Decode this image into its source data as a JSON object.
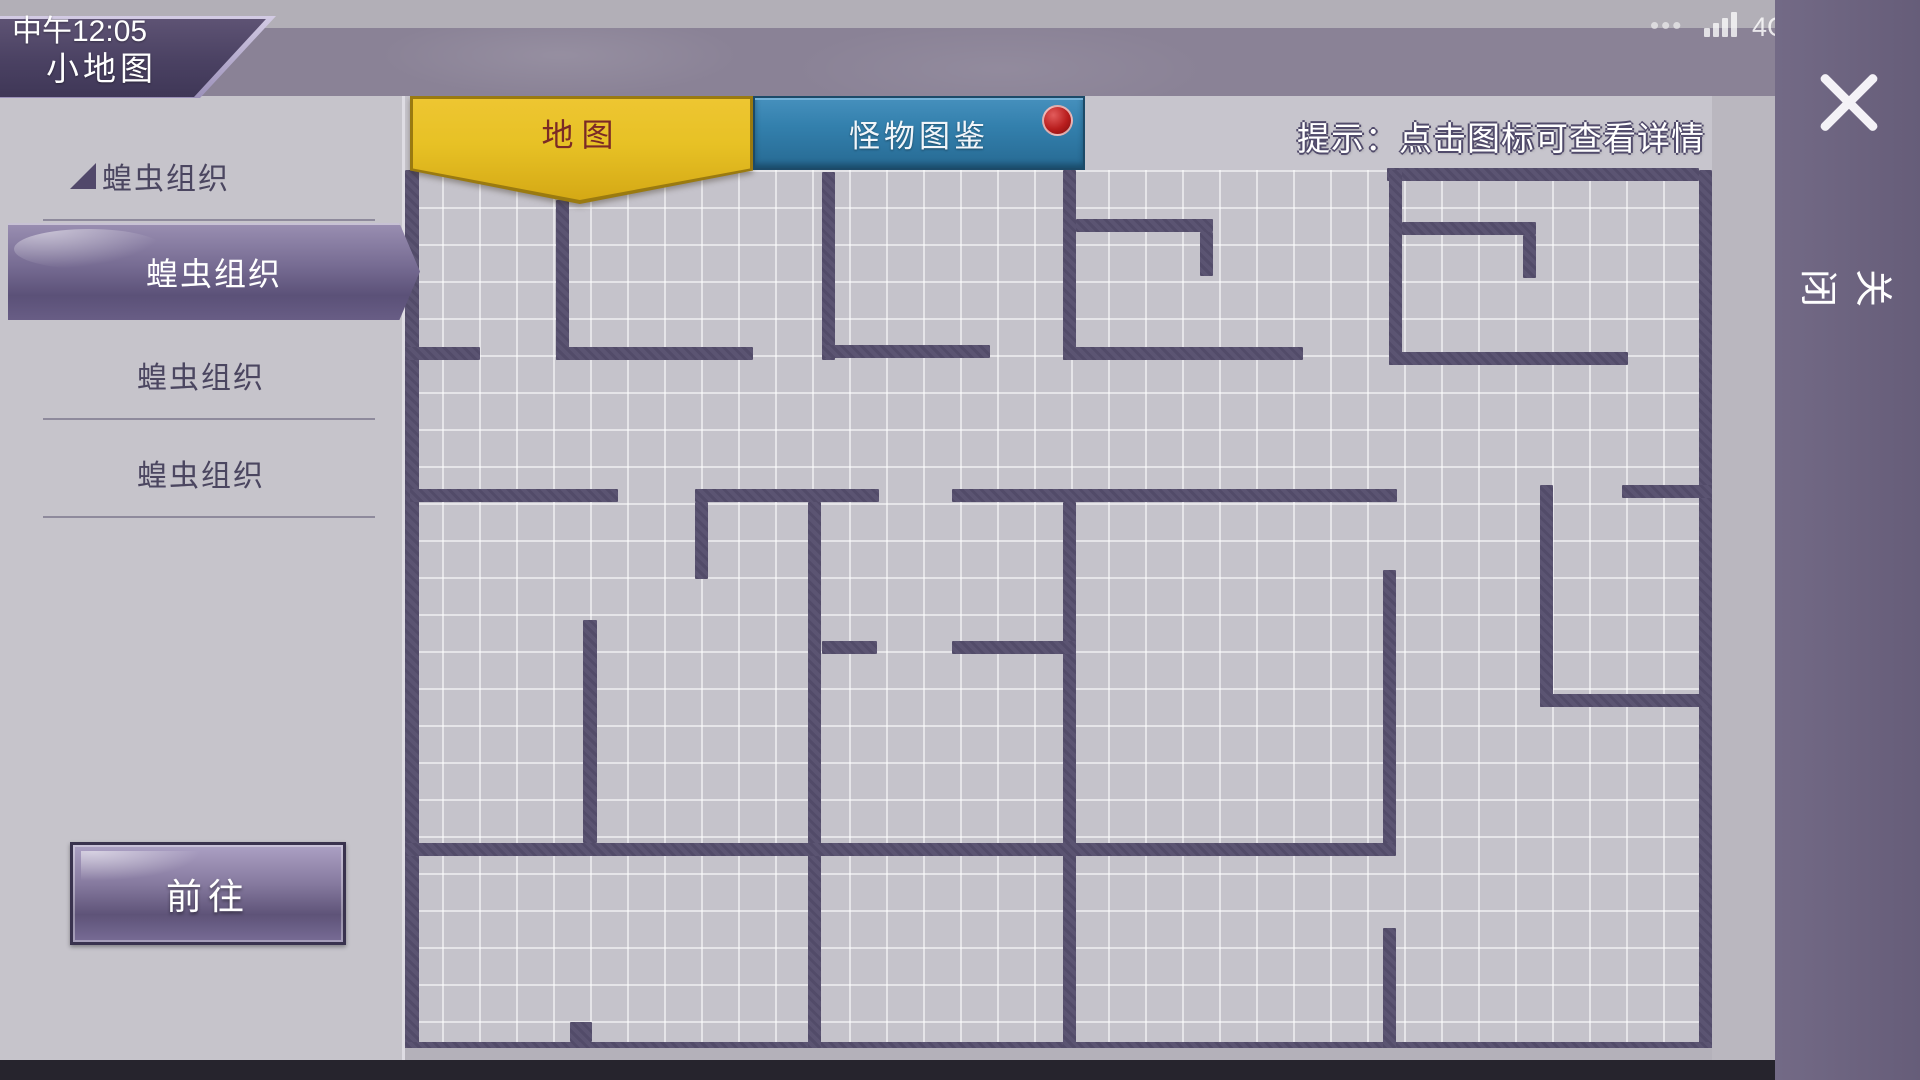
{
  "status_bar": {
    "time": "中午12:05",
    "page_title": "小地图",
    "menu_dots": "•••",
    "network": "4G",
    "network_arrows": "⇵",
    "battery_level": "82"
  },
  "right_panel": {
    "close_label": "关闭"
  },
  "sidebar": {
    "group_header": "蝗虫组织",
    "items": [
      {
        "label": "蝗虫组织",
        "selected": true
      },
      {
        "label": "蝗虫组织",
        "selected": false
      },
      {
        "label": "蝗虫组织",
        "selected": false
      }
    ],
    "go_button_label": "前往"
  },
  "tab_bar": {
    "map_tab": "地图",
    "bestiary_tab": "怪物图鉴",
    "bestiary_has_notification": true,
    "tip": "提示：点击图标可查看详情"
  },
  "colors": {
    "accent_purple": "#6b6087",
    "tab_yellow": "#e7c125",
    "tab_blue": "#3380ad",
    "notification_red": "#b81d1d",
    "wall": "#5b5472",
    "battery_text": "#b23535"
  },
  "map": {
    "grid_cell_px": 37,
    "grid_area": [
      405,
      170,
      1307,
      878
    ],
    "walls": [
      [
        405,
        170,
        14,
        878
      ],
      [
        1699,
        170,
        13,
        885
      ],
      [
        1387,
        168,
        312,
        13
      ],
      [
        405,
        1042,
        1307,
        13
      ],
      [
        556,
        200,
        13,
        160
      ],
      [
        822,
        172,
        13,
        188
      ],
      [
        1063,
        170,
        13,
        190
      ],
      [
        1389,
        170,
        13,
        195
      ],
      [
        405,
        347,
        75,
        13
      ],
      [
        556,
        347,
        197,
        13
      ],
      [
        822,
        345,
        168,
        13
      ],
      [
        1063,
        347,
        240,
        13
      ],
      [
        1389,
        352,
        239,
        13
      ],
      [
        1076,
        219,
        137,
        13
      ],
      [
        1200,
        232,
        13,
        44
      ],
      [
        1402,
        222,
        134,
        13
      ],
      [
        1523,
        235,
        13,
        43
      ],
      [
        410,
        489,
        208,
        13
      ],
      [
        695,
        489,
        184,
        13
      ],
      [
        952,
        489,
        445,
        13
      ],
      [
        1622,
        485,
        90,
        13
      ],
      [
        695,
        502,
        13,
        77
      ],
      [
        808,
        502,
        13,
        546
      ],
      [
        1063,
        502,
        13,
        546
      ],
      [
        1383,
        570,
        13,
        282
      ],
      [
        1540,
        485,
        13,
        222
      ],
      [
        1540,
        694,
        172,
        13
      ],
      [
        822,
        641,
        55,
        13
      ],
      [
        952,
        641,
        124,
        13
      ],
      [
        405,
        843,
        991,
        13
      ],
      [
        583,
        620,
        14,
        223
      ],
      [
        1383,
        928,
        13,
        120
      ],
      [
        570,
        1022,
        22,
        20
      ]
    ]
  }
}
